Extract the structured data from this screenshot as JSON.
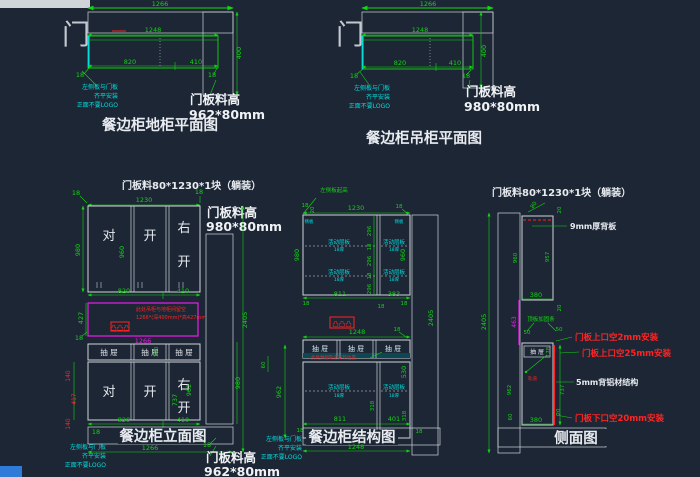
{
  "colors": {
    "bg": "#1c2634",
    "green": "#12d612",
    "cyan": "#00dede",
    "red": "#ff2424",
    "magenta": "#ea1cea",
    "white": "#e8ebf0",
    "blue_chip": "#2f7cd8"
  },
  "base_plan": {
    "door": "门",
    "title": "餐边柜地柜平面图",
    "dims": {
      "total": "1266",
      "inner": "1248",
      "left": "820",
      "right": "410",
      "t18l": "18",
      "t18r": "18",
      "depth": "400"
    },
    "note": [
      "左侧板与门板",
      "齐平安装",
      "正面不要LOGO"
    ],
    "label": [
      "门板料高",
      "962*80mm"
    ]
  },
  "wall_plan": {
    "door": "门",
    "title": "餐边柜吊柜平面图",
    "dims": {
      "total": "1266",
      "inner": "1248",
      "left": "820",
      "right": "410",
      "t18l": "18",
      "t18r": "18",
      "depth": "400"
    },
    "note": [
      "左侧板与门板",
      "齐平安装",
      "正面不要LOGO"
    ],
    "label": [
      "门板料高",
      "980*80mm"
    ]
  },
  "elevation": {
    "header": "门板料80*1230*1块（躺装）",
    "top": {
      "t18l": "18",
      "width": "1230",
      "t18r": "18"
    },
    "side_label": [
      "门板料高",
      "980*80mm"
    ],
    "upper_doors": {
      "d1": "对",
      "d2": "开",
      "d3a": "右",
      "d3b": "开"
    },
    "upper_dims": {
      "h980": "980",
      "h960": "960",
      "w820": "820",
      "w410": "410"
    },
    "niche": {
      "note1": "此处吊柜与地柜间留空",
      "note2": "1266*(深400mm)*高427mm",
      "outlets": "凸凸凸",
      "h427": "427",
      "t18": "18",
      "w1266": "1266"
    },
    "drawers": {
      "d1": "抽 屉",
      "d2": "抽 屉",
      "d3": "抽 屉",
      "h180": "180"
    },
    "lower_doors": {
      "d1": "对",
      "d2": "开",
      "d3a": "右",
      "d3b": "开"
    },
    "lower_dims": {
      "r140a": "140",
      "r417": "417",
      "r140b": "140",
      "h737": "737",
      "h962": "962",
      "h980": "980",
      "h2405": "2405",
      "w820": "820",
      "w410": "410"
    },
    "bottom": {
      "t18l": "18",
      "w1266": "1266",
      "t18r": "18"
    },
    "title": "餐边柜立面图",
    "label": [
      "门板料高",
      "962*80mm"
    ],
    "note": [
      "左侧板与门板",
      "齐平安装",
      "正面不要LOGO"
    ]
  },
  "structure": {
    "corner_note": "左侧板起高",
    "top": {
      "t18": "18",
      "t20": "20",
      "w1230": "1230",
      "t18r": "18"
    },
    "panel_tag_l": "侧板",
    "panel_tag_r": "侧板",
    "shelf": {
      "label": "活动层板",
      "sub": "18厚"
    },
    "upper_dims": {
      "h980": "980",
      "c296a": "296",
      "c18a": "18",
      "c296b": "296",
      "c18b": "18",
      "c296c": "296",
      "h960": "960",
      "w811": "811",
      "w383": "383",
      "b18l": "18",
      "b18m": "18",
      "b18r": "18"
    },
    "mid": {
      "outlets": "凸凸凸",
      "w1248": "1248",
      "t18": "18",
      "d1": "抽 屉",
      "d2": "抽 屉",
      "d3": "抽 屉",
      "red_note": "此处预留轨道安装位置",
      "h60": "60",
      "h962": "962",
      "h530": "530",
      "h318a": "318",
      "h318b": "318",
      "h2405": "2405"
    },
    "bottom": {
      "w811": "811",
      "w401": "401",
      "t18l": "18",
      "t18m": "18",
      "t50": "50",
      "t18r": "18",
      "w1248": "1248"
    },
    "title": "餐边柜结构图",
    "note": [
      "左侧板与门板",
      "齐平安装",
      "正面不要LOGO"
    ]
  },
  "side_view": {
    "header": "门板料80*1230*1块（躺装）",
    "upper": {
      "w80": "80",
      "t20a": "20",
      "h960": "960",
      "h957": "957",
      "w380": "380",
      "t20b": "20",
      "back_label": "9mm厚背板"
    },
    "left": {
      "h2405": "2405",
      "h463": "463",
      "h962": "962",
      "h60": "60"
    },
    "base": {
      "note": "顶板加固条",
      "t50a": "50",
      "t50b": "50",
      "h178": "178",
      "drawer": "抽 屉",
      "rail_note": "轨道",
      "h737": "737",
      "t20": "20",
      "w380": "380"
    },
    "red_note1": "门板上口空2mm安装",
    "red_note2": "门板上口空25mm安装",
    "red_note3": "门板下口空20mm安装",
    "alu_label": "5mm背铝材结构",
    "title": "侧面图"
  }
}
